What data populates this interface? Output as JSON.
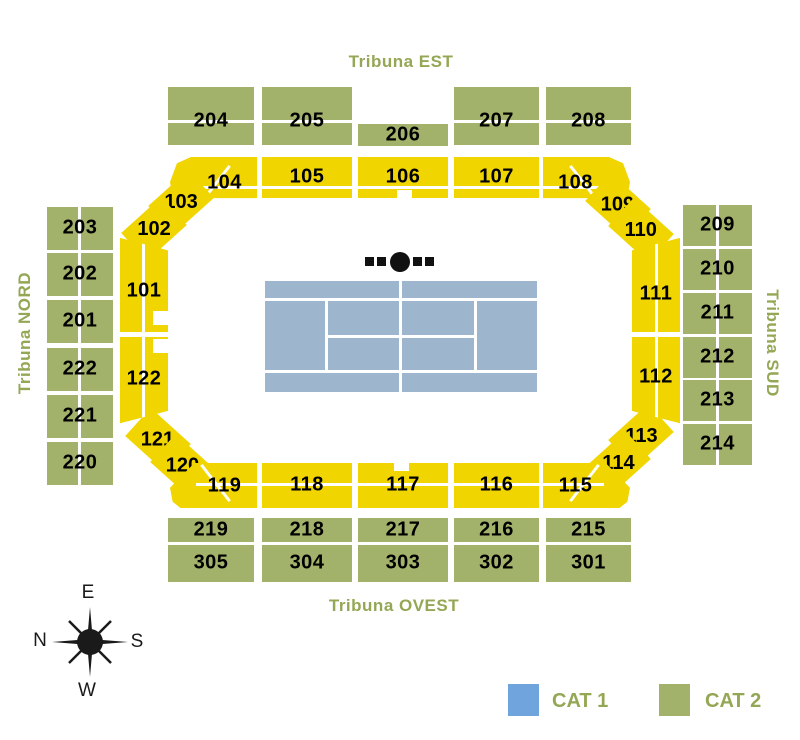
{
  "stands": {
    "est": "Tribuna EST",
    "nord": "Tribuna NORD",
    "sud": "Tribuna SUD",
    "ovest": "Tribuna OVEST"
  },
  "sections": {
    "est_outer": [
      "204",
      "205",
      "206",
      "207",
      "208"
    ],
    "est_inner": [
      "104",
      "105",
      "106",
      "107",
      "108"
    ],
    "nord_outer": [
      "203",
      "202",
      "201",
      "222",
      "221",
      "220"
    ],
    "nord_inner": [
      "101",
      "122"
    ],
    "sud_outer": [
      "209",
      "210",
      "211",
      "212",
      "213",
      "214"
    ],
    "sud_inner": [
      "111",
      "112"
    ],
    "ovest_inner": [
      "119",
      "118",
      "117",
      "116",
      "115"
    ],
    "ovest_outer": [
      "219",
      "218",
      "217",
      "216",
      "215"
    ],
    "ovest_lower": [
      "305",
      "304",
      "303",
      "302",
      "301"
    ],
    "corners": {
      "nw": [
        "103",
        "102"
      ],
      "ne": [
        "109",
        "110"
      ],
      "sw": [
        "121",
        "120"
      ],
      "se": [
        "113",
        "114"
      ]
    }
  },
  "compass": {
    "top": "E",
    "left": "N",
    "right": "S",
    "bottom": "W"
  },
  "legend": {
    "items": [
      {
        "label": "CAT 1",
        "color": "#6FA5DC"
      },
      {
        "label": "CAT 2",
        "color": "#A3B26A"
      }
    ]
  },
  "colors": {
    "ring_yellow": "#F0D500",
    "cat2_green": "#A3B26A",
    "cat1_blue": "#6FA5DC",
    "court_blue": "#9DB6CD",
    "label_green": "#94A755",
    "text_black": "#000000"
  }
}
